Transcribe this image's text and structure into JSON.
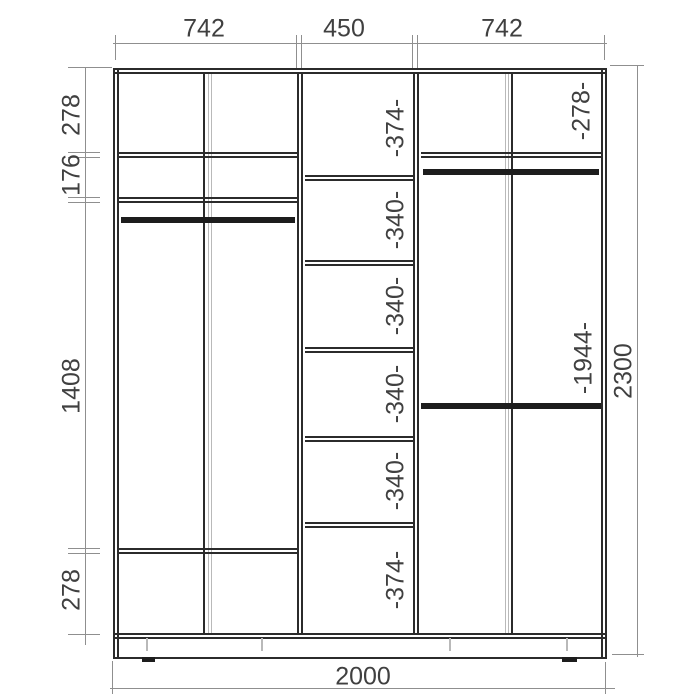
{
  "dimensions": {
    "top_widths": [
      "742",
      "450",
      "742"
    ],
    "left_heights": [
      "278",
      "176",
      "1408",
      "278"
    ],
    "overall_height": "2300",
    "overall_width": "2000",
    "center_column_sections": [
      "-374-",
      "-340-",
      "-340-",
      "-340-",
      "-340-",
      "-374-"
    ],
    "right_column_top_section": "-278-",
    "right_column_tall_section": "-1944-"
  },
  "colors": {
    "structure_line": "#2b2b2b",
    "rod_fill": "#1d1d1d",
    "dimension_line": "#8f8f8f",
    "light_guide_line": "#b9b9b9",
    "text": "#404040",
    "background": "#ffffff"
  }
}
